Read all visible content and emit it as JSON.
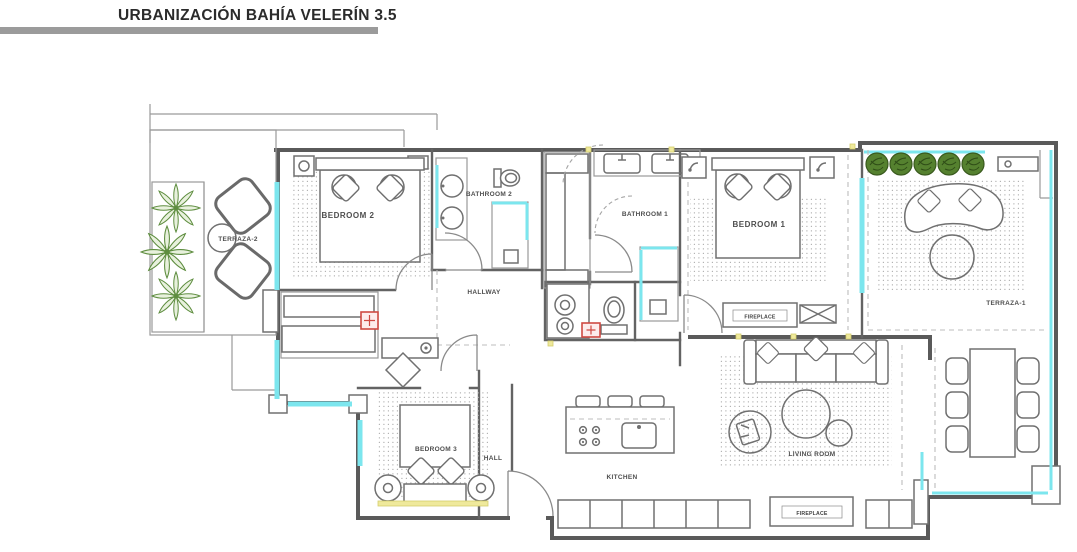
{
  "header": {
    "title": "URBANIZACIÓN BAHÍA VELERÍN 3.5"
  },
  "plan": {
    "rooms": {
      "terraza_2": "TERRAZA-2",
      "bedroom_2": "BEDROOM 2",
      "bathroom_2": "BATHROOM 2",
      "bathroom_1": "BATHROOM 1",
      "bedroom_1": "BEDROOM 1",
      "terraza_1": "TERRAZA-1",
      "hallway": "HALLWAY",
      "bedroom_3": "BEDROOM 3",
      "hall": "HALL",
      "kitchen": "KITCHEN",
      "living_room": "LIVING ROOM",
      "fireplace_bedroom": "FIREPLACE",
      "fireplace_kitchen": "FIREPLACE"
    },
    "colors": {
      "glass": "#7ce6ee",
      "plant_green": "#5e8d3f",
      "bush_green": "#4e7c2c",
      "marker_red": "#cf4a43",
      "sill_yellow": "#efe99c",
      "wall_gray": "#5a5a5a",
      "title_bar_gray": "#9b9b9b"
    }
  }
}
